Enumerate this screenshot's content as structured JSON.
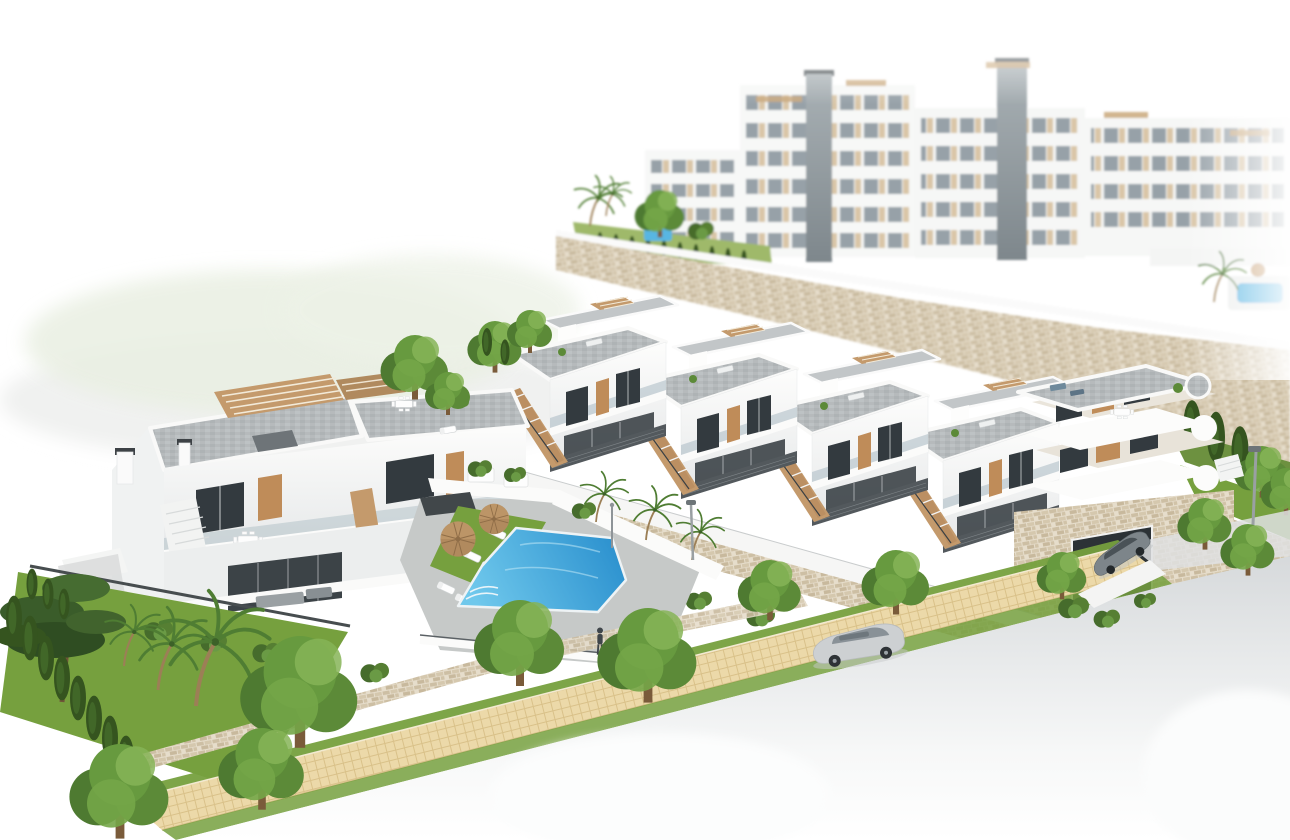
{
  "scene": {
    "label": "Aerial 3D architectural rendering of a white residential development: a row of modern townhouses with rooftop terraces and wooden stairs, a two-unit villa, a communal blue pool with sun loungers and parasols, multi-storey apartment blocks behind a stone retaining wall, gardens with pines, palms and cypresses, and a street with a cobblestone sidewalk and parked cars",
    "type": "architectural-render",
    "background": {
      "apartment_blocks": 4,
      "stair_towers": 2,
      "roof_pergolas": 5,
      "small_pools": 2,
      "garden_terrace": true
    },
    "midground": {
      "townhouse_units": 4,
      "corner_building_floors": 3,
      "corner_building_garage": true,
      "stone_retaining_walls": 3,
      "access_ramp": true
    },
    "left_building": {
      "units": 2,
      "roof_pergolas": 2,
      "chimneys": 2,
      "roof_terraces": 2,
      "dining_sets": 2
    },
    "pool_area": {
      "pool_color_deep": "#2d92cf",
      "pool_color_shallow": "#6fc8ec",
      "parasols": 2,
      "sun_loungers": 8,
      "lawn": true,
      "people_walking": 2,
      "small_palms": 3,
      "outdoor_shower": 1
    },
    "street": {
      "sidewalk": "cobblestone",
      "parked_car_silver": 1,
      "parked_car_gray": 1,
      "faded_cars": 2,
      "street_lamps": 2,
      "driveway": true
    },
    "vegetation": {
      "pine_trees": 1,
      "cypresses": 17,
      "palm_trees": 6,
      "leafy_trees": 14,
      "bushes": 9
    }
  },
  "palette": {
    "white": "#fbfbfa",
    "deck": "#b7bcbe",
    "wood": "#c49a6c",
    "wood2": "#bf8c59",
    "stone": "#d9cdb8",
    "grass": "#76a03e",
    "tree1": "#4e7a31",
    "tree2": "#6a9a45",
    "cypress": "#35541f",
    "pool1": "#2d92cf",
    "pool2": "#6fc8ec",
    "road": "#d6d9db",
    "path": "#ecd9a9",
    "win": "#333a3f",
    "glass": "#a9bac2",
    "louver": "#53595d",
    "carsilver": "#cdd0d2",
    "cargray": "#7d858a",
    "trunk": "#8a6a48"
  }
}
